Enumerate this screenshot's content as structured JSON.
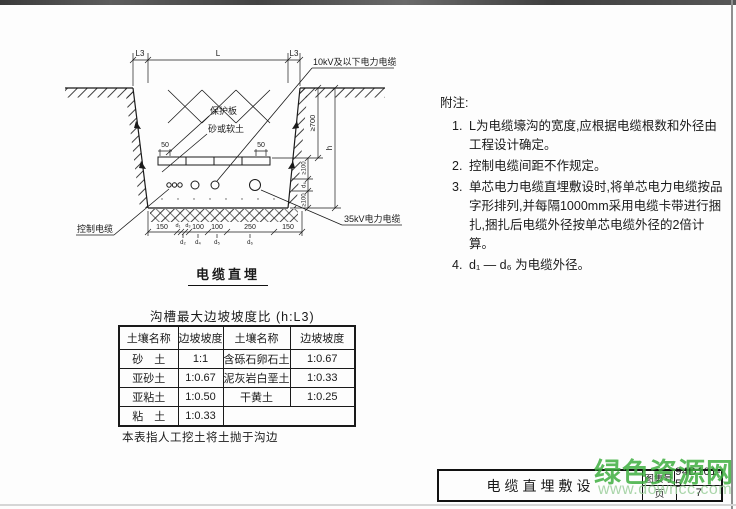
{
  "diagram": {
    "title": "电缆直埋",
    "labels": {
      "l3_left": "L3",
      "l_mid": "L",
      "l3_right": "L3",
      "cable_10kv": "10kV及以下电力电缆",
      "protective_board": "保护板",
      "sand_soft_soil": "砂或软土",
      "depth_700": "≥700",
      "depth_h": "h",
      "gap_100_upper": "≥100",
      "d6_side": "d₆",
      "gap_100_lower": "≥100",
      "control_cable": "控制电缆",
      "cable_35kv": "35kV电力电缆",
      "board_50_left": "50",
      "board_50_right": "50"
    },
    "bottom_dims_top": [
      "150",
      "d₁",
      "d₃",
      "100",
      "100",
      "250",
      "150"
    ],
    "bottom_dims_bottom": [
      "d₂",
      "d₄",
      "d₅",
      "d₆"
    ]
  },
  "table": {
    "caption": "沟槽最大边坡坡度比 (h:L3)",
    "headers": [
      "土壤名称",
      "边坡坡度",
      "土壤名称",
      "边坡坡度"
    ],
    "rows": [
      [
        "砂　土",
        "1:1",
        "含砾石卵石土",
        "1:0.67"
      ],
      [
        "亚砂土",
        "1:0.67",
        "泥灰岩白垩土",
        "1:0.33"
      ],
      [
        "亚粘土",
        "1:0.50",
        "干黄土",
        "1:0.25"
      ],
      [
        "粘　土",
        "1:0.33",
        "",
        ""
      ]
    ],
    "footnote": "本表指人工挖土将土抛于沟边"
  },
  "notes": {
    "title": "附注:",
    "items": [
      {
        "num": "1.",
        "text": "L为电缆壕沟的宽度,应根据电缆根数和外径由工程设计确定。"
      },
      {
        "num": "2.",
        "text": "控制电缆间距不作规定。"
      },
      {
        "num": "3.",
        "text": "单芯电力电缆直埋敷设时,将单芯电力电缆按品字形排列,并每隔1000mm采用电缆卡带进行捆扎,捆扎后电缆外径按单芯电缆外径的2倍计算。"
      },
      {
        "num": "4.",
        "text": "d₁ — d₆ 为电缆外径。"
      }
    ]
  },
  "titleblock": {
    "title": "电缆直埋敷设",
    "atlas_label": "图集号",
    "atlas_no": "94D101-5",
    "page_label": "页",
    "page_no": "7"
  },
  "watermark": {
    "name": "绿色资源网",
    "url": "www.downcc.com",
    "green": "#3eae3f",
    "light_green": "#a0d0a0"
  }
}
